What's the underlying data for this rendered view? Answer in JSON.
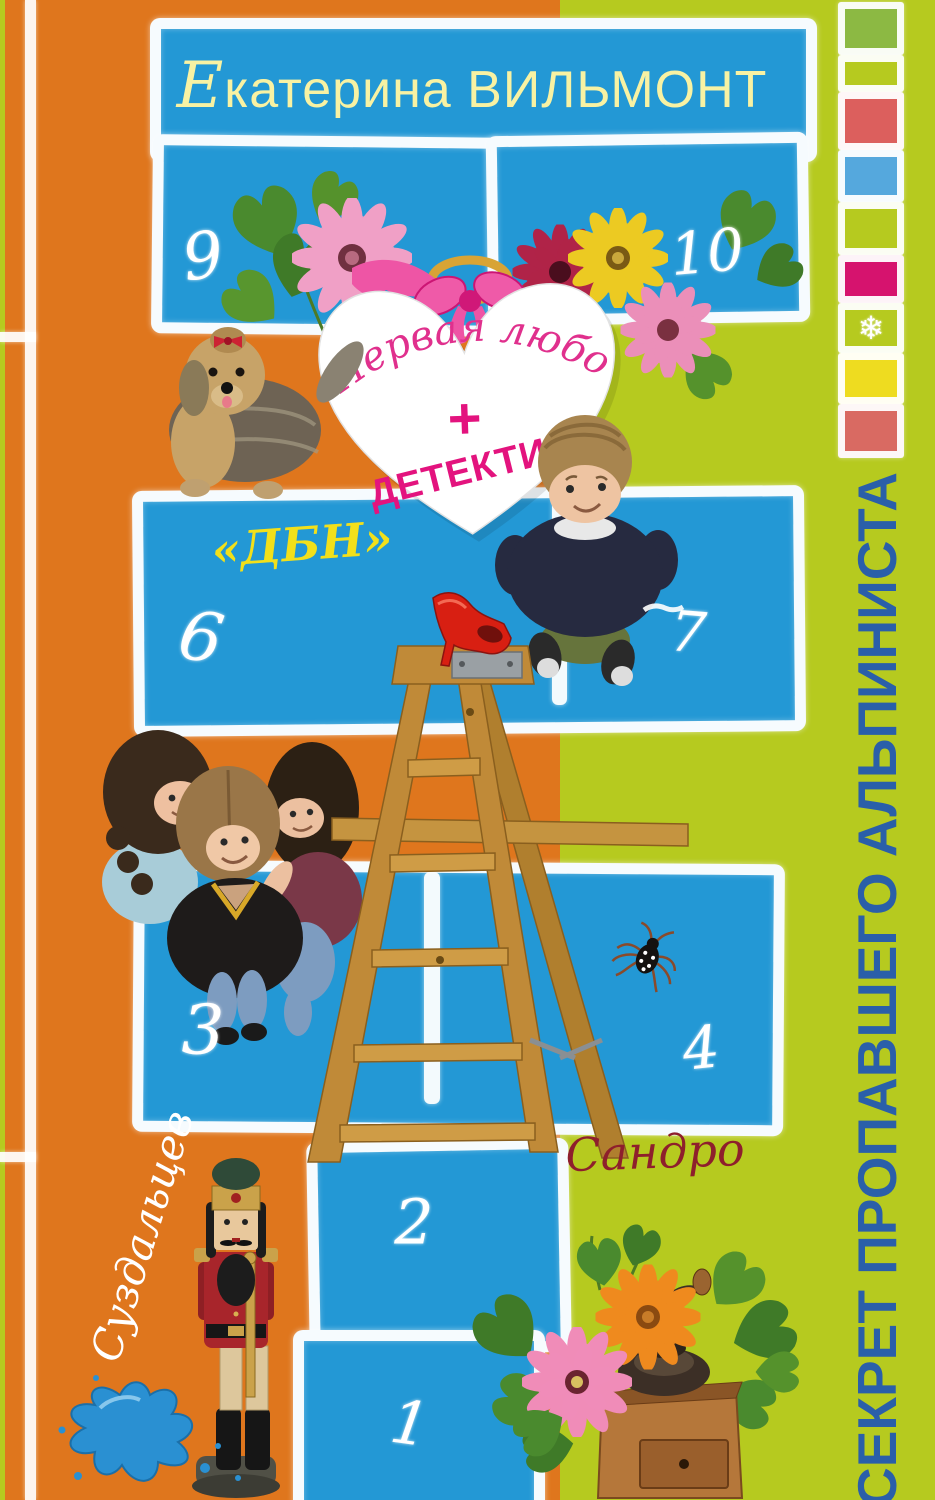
{
  "cover": {
    "author": {
      "initial": "Е",
      "rest": "катерина ВИЛЬМОНТ"
    },
    "heart_badge": {
      "line1": "Первая любовь",
      "plus": "+",
      "line2": "ДЕТЕКТИВ"
    },
    "spine_title": "СЕКРЕТ ПРОПАВШЕГО АЛЬПИНИСТА",
    "handwritten": {
      "dbn": "«ДБН»",
      "sandro": "Сандро",
      "suzdaltsev": "Суздальцев"
    },
    "hopscotch": {
      "squares": [
        {
          "label": "9"
        },
        {
          "label": "10"
        },
        {
          "label": "6"
        },
        {
          "label": "7"
        },
        {
          "label": "3"
        },
        {
          "label": "4"
        },
        {
          "label": "2"
        },
        {
          "label": "1"
        }
      ]
    },
    "icons": {
      "snowflake": "❄"
    },
    "colors": {
      "orange": "#df761d",
      "lime": "#b6ca1f",
      "blue": "#2398d5",
      "chalk": "#ffffff",
      "author_text": "#f8f2a3",
      "pink_script": "#e0308d",
      "pink_bold": "#e3137e",
      "yellow_script": "#f2e01a",
      "spine_blue": "#2a5fa9",
      "dark_red": "#8e1f2c",
      "splat_blue": "#2a90d2",
      "strip": {
        "green": "#8cb943",
        "red": "#dc5f5d",
        "blue": "#55a8dd",
        "magenta": "#d6136e",
        "yellow": "#eedc20",
        "coral": "#d96a62"
      }
    }
  }
}
